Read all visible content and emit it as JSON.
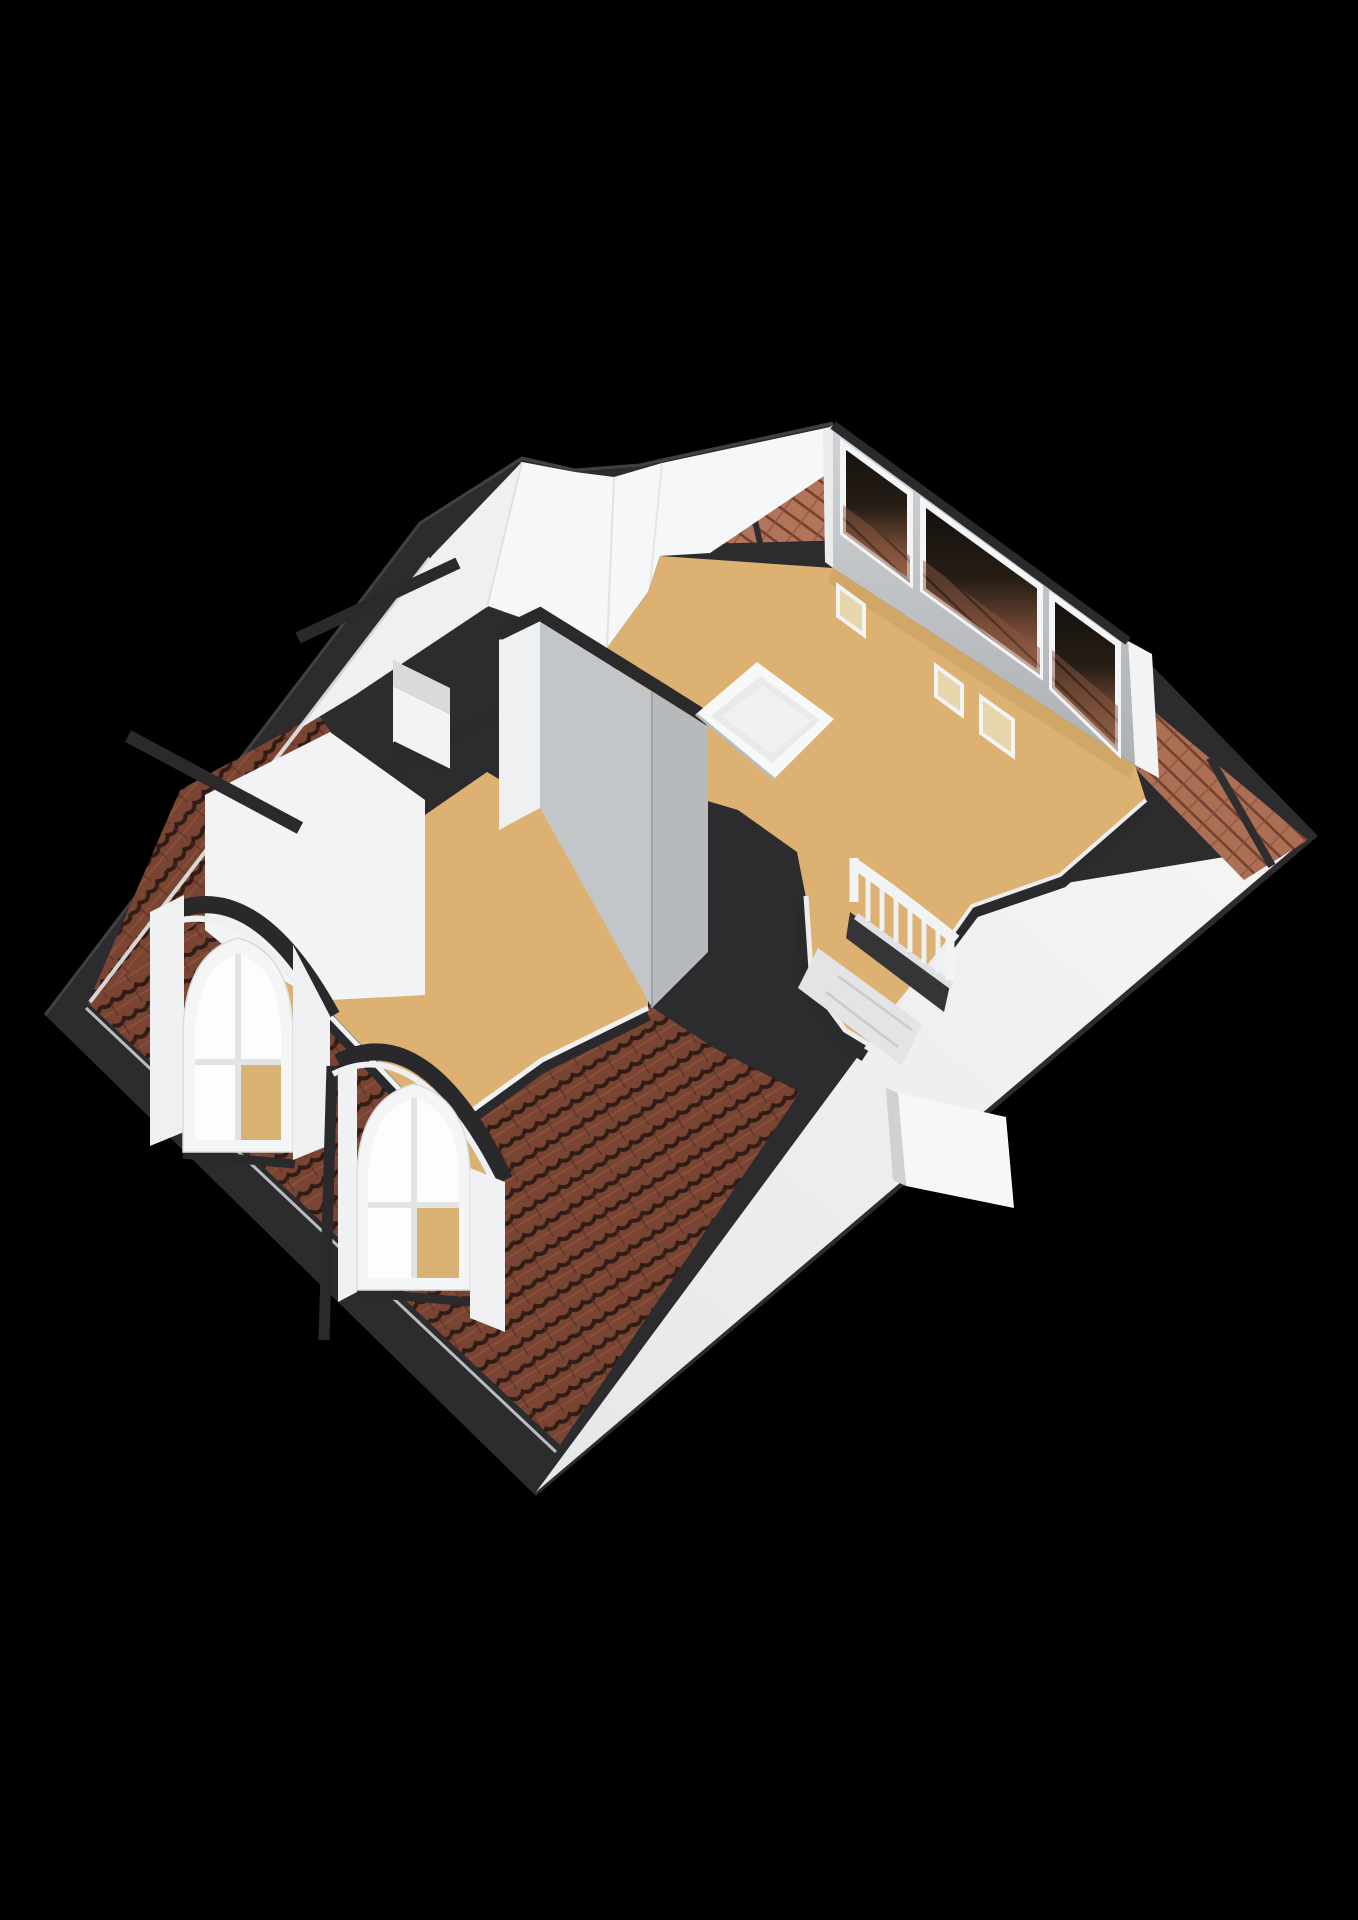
{
  "meta": {
    "description": "3D rendered attic floor plan viewed isometrically from above on a black background",
    "image_type": "3d-floorplan-render"
  },
  "canvas": {
    "width": 1358,
    "height": 1920,
    "background": "#000000"
  },
  "colors": {
    "background": "#000000",
    "roof_band": "#2c2c2e",
    "roof_band_highlight": "#4a4b4d",
    "cap_dark": "#2a2a2c",
    "tile_dark": "#7a4433",
    "tile_dark_line": "#2e1c15",
    "tile_light": "#b3755a",
    "tile_light_line": "#713f2f",
    "floor": "#dcb172",
    "floor_shadow": "#c79e5f",
    "ceiling": "#f6f7f8",
    "ceiling_shade": "#eef0f1",
    "wall_white": "#f2f3f4",
    "wall_light": "#d8dadb",
    "wall_mid": "#c3c6c8",
    "wall_dark": "#b7babc",
    "wall_face_top": "#d0d3d5",
    "wall_face_bottom": "#aeb1b3",
    "rear_slope_top": "#f4f5f5",
    "rear_slope_bottom": "#e6e7e8",
    "glass_top": "#14100d",
    "glass_bottom": "#a76f52",
    "rail": "#f2f3f4",
    "interior_tan": "#d9b173",
    "niche_tan": "#e7d5ac",
    "step_gray": "#e2e4e5",
    "void_dark": "#353537",
    "skylight": "#e9eaeb",
    "trim_white": "#ececed"
  },
  "scene": {
    "roof": {
      "cut_style": "dark cut band outlines the whole floor",
      "tiled_slopes": 4,
      "tile_style": "curved clay tiles, brown",
      "rear_slope_finish": "plain white untextured slope at lower right",
      "rear_slope_dormer_boxes": 1
    },
    "front_window_wall": {
      "position": "upper right",
      "window_panes": 3,
      "glass": "dark glazing with roof tiles visible through lower half",
      "base_niches": 3
    },
    "dormers": [
      {
        "id": "dormer-upper-left",
        "window": "arched white frame, 4 panes",
        "roof": "curved dark fascia"
      },
      {
        "id": "dormer-lower-center",
        "window": "arched white frame, 4 panes",
        "roof": "curved dark fascia"
      }
    ],
    "rooms": [
      {
        "id": "main-room",
        "floor": "tan",
        "features": [
          "skylight-hatch",
          "stair-opening"
        ]
      },
      {
        "id": "side-room",
        "floor": "tan",
        "features": [
          "dormer windows"
        ]
      }
    ],
    "staircase": {
      "railing_balusters": 6,
      "railing_finish": "white",
      "flight": "descending to lower floor"
    },
    "skylight_hatch": {
      "shape": "white framed rectangular opening in main room"
    },
    "chimney": {
      "position": "on interior wall at left",
      "finish": "white with grey cap"
    }
  }
}
